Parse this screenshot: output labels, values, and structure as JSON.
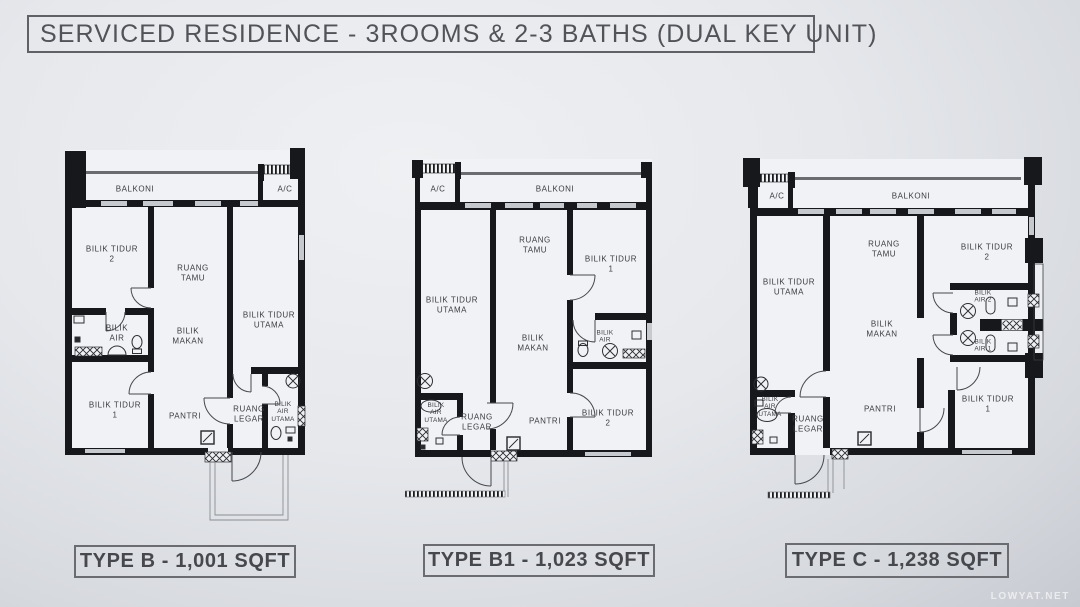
{
  "title": "SERVICED RESIDENCE - 3ROOMS & 2-3 BATHS (DUAL KEY UNIT)",
  "watermark": "LOWYAT.NET",
  "plans": [
    {
      "type_label": "TYPE B - 1,001 SQFT",
      "rooms": {
        "balkoni": {
          "l1": "BALKONI"
        },
        "ac": {
          "l1": "A/C"
        },
        "bilik_tidur_2": {
          "l1": "BILIK TIDUR",
          "l2": "2"
        },
        "ruang_tamu": {
          "l1": "RUANG",
          "l2": "TAMU"
        },
        "bilik_tidur_utama": {
          "l1": "BILIK TIDUR",
          "l2": "UTAMA"
        },
        "bilik_air": {
          "l1": "BILIK",
          "l2": "AIR"
        },
        "bilik_makan": {
          "l1": "BILIK",
          "l2": "MAKAN"
        },
        "bilik_tidur_1": {
          "l1": "BILIK TIDUR",
          "l2": "1"
        },
        "pantri": {
          "l1": "PANTRI"
        },
        "ruang_legar": {
          "l1": "RUANG",
          "l2": "LEGAR"
        },
        "bilik_air_utama": {
          "l1": "BILIK",
          "l2": "AIR",
          "l3": "UTAMA"
        }
      }
    },
    {
      "type_label": "TYPE B1 - 1,023 SQFT",
      "rooms": {
        "ac": {
          "l1": "A/C"
        },
        "balkoni": {
          "l1": "BALKONI"
        },
        "bilik_tidur_utama": {
          "l1": "BILIK TIDUR",
          "l2": "UTAMA"
        },
        "ruang_tamu": {
          "l1": "RUANG",
          "l2": "TAMU"
        },
        "bilik_tidur_1": {
          "l1": "BILIK TIDUR",
          "l2": "1"
        },
        "bilik_makan": {
          "l1": "BILIK",
          "l2": "MAKAN"
        },
        "bilik_air": {
          "l1": "BILIK",
          "l2": "AIR"
        },
        "bilik_tidur_2": {
          "l1": "BILIK TIDUR",
          "l2": "2"
        },
        "pantri": {
          "l1": "PANTRI"
        },
        "ruang_legar": {
          "l1": "RUANG",
          "l2": "LEGAR"
        },
        "bilik_air_utama": {
          "l1": "BILIK",
          "l2": "AIR",
          "l3": "UTAMA"
        }
      }
    },
    {
      "type_label": "TYPE C - 1,238 SQFT",
      "rooms": {
        "ac": {
          "l1": "A/C"
        },
        "balkoni": {
          "l1": "BALKONI"
        },
        "bilik_tidur_utama": {
          "l1": "BILIK TIDUR",
          "l2": "UTAMA"
        },
        "ruang_tamu": {
          "l1": "RUANG",
          "l2": "TAMU"
        },
        "bilik_tidur_2": {
          "l1": "BILIK TIDUR",
          "l2": "2"
        },
        "bilik_makan": {
          "l1": "BILIK",
          "l2": "MAKAN"
        },
        "bilik_air_2": {
          "l1": "BILIK",
          "l2": "AIR 2"
        },
        "bilik_air_1": {
          "l1": "BILIK",
          "l2": "AIR 1"
        },
        "bilik_tidur_1": {
          "l1": "BILIK TIDUR",
          "l2": "1"
        },
        "pantri": {
          "l1": "PANTRI"
        },
        "ruang_legar": {
          "l1": "RUANG",
          "l2": "LEGAR"
        },
        "bilik_air_utama": {
          "l1": "BILIK",
          "l2": "AIR",
          "l3": "UTAMA"
        }
      }
    }
  ]
}
